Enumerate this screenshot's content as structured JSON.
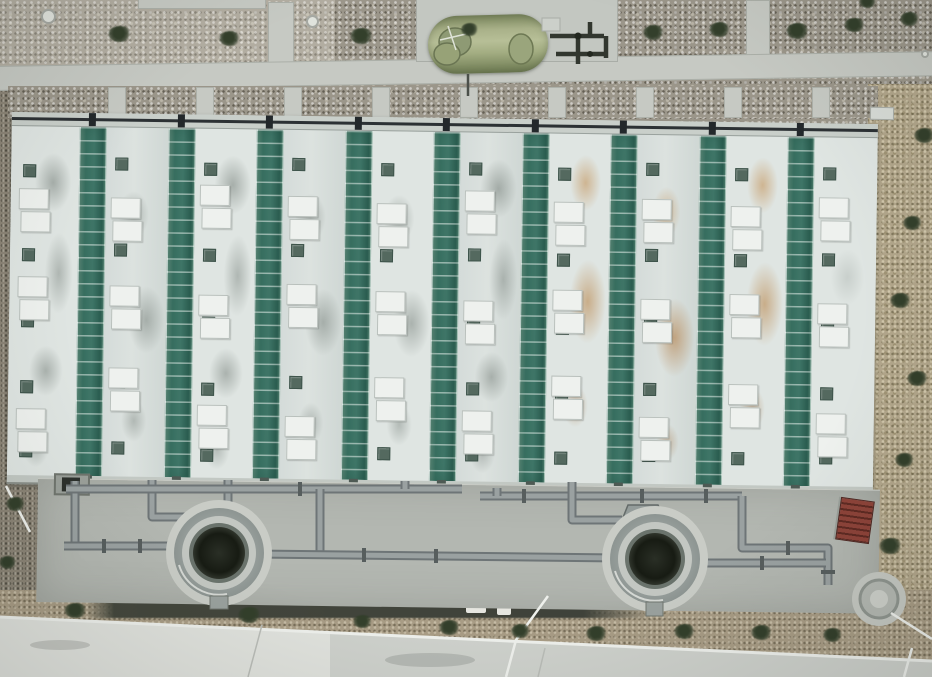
{
  "scene": {
    "width": 932,
    "height": 677,
    "description": "Aerial drone photograph of a wastewater treatment facility: long building with alternating white and green ribbed roof strips, concrete apron with two circular clarifier tanks and grey process piping, olive-green horizontal storage tank on a concrete pad at top, gravel grounds with shrubs, concrete paths, dirt strip and access road at bottom"
  },
  "palette": {
    "gravel": "#9b968a",
    "dry_grass": "#b2a68b",
    "dirt": "#a89c85",
    "concrete_path": "#c6c9c3",
    "apron": "#b3b7b1",
    "road": "#ced1cc",
    "roof_white": "#dfe5e2",
    "roof_green": "#3d7466",
    "roof_green_rib": "#7aa191",
    "eave": "#c9cfca",
    "pipe_grey": "#8b9293",
    "pipe_dark": "#23282b",
    "storage_tank_green": "#a9b189",
    "stairs_red": "#7e3a31",
    "shrub_green": "#333f2b",
    "trench_dark": "#44473d",
    "white_line": "#eef0ec"
  },
  "roof": {
    "x": 12,
    "y": 112,
    "w": 866,
    "h": 372,
    "rotate_deg": 0.8,
    "eave_h": 14,
    "bottom_h": 9,
    "green_w": 27,
    "greens": [
      68,
      157,
      245,
      334,
      422,
      511,
      599,
      688,
      776
    ],
    "whites": [
      {
        "x": 0,
        "w": 68,
        "tone": "a",
        "stain": "gray-a",
        "sqx": 12,
        "panx": 8,
        "squares": [
          38,
          122,
          188,
          254,
          318
        ],
        "panels": [
          62,
          150,
          282
        ]
      },
      {
        "x": 95,
        "w": 62,
        "tone": "b",
        "stain": "gray-b",
        "sqx": 9,
        "panx": 5,
        "squares": [
          30,
          116,
          182,
          248,
          314
        ],
        "panels": [
          70,
          158,
          240
        ]
      },
      {
        "x": 184,
        "w": 61,
        "tone": "a",
        "stain": "gray-a",
        "sqx": 9,
        "panx": 5,
        "squares": [
          34,
          120,
          188,
          254,
          320
        ],
        "panels": [
          56,
          166,
          276
        ]
      },
      {
        "x": 272,
        "w": 62,
        "tone": "b",
        "stain": "gray-b",
        "sqx": 9,
        "panx": 5,
        "squares": [
          28,
          114,
          180,
          246,
          312
        ],
        "panels": [
          66,
          154,
          286
        ]
      },
      {
        "x": 361,
        "w": 61,
        "tone": "a",
        "stain": "gray-b",
        "sqx": 9,
        "panx": 5,
        "squares": [
          32,
          118,
          186,
          252,
          316
        ],
        "panels": [
          72,
          160,
          246
        ]
      },
      {
        "x": 449,
        "w": 62,
        "tone": "b",
        "stain": "gray-a",
        "sqx": 9,
        "panx": 5,
        "squares": [
          30,
          116,
          184,
          250,
          316
        ],
        "panels": [
          58,
          168,
          278
        ]
      },
      {
        "x": 538,
        "w": 61,
        "tone": "a",
        "stain": "rust-a",
        "sqx": 9,
        "panx": 5,
        "squares": [
          34,
          120,
          188,
          254,
          318
        ],
        "panels": [
          68,
          156,
          242
        ]
      },
      {
        "x": 626,
        "w": 62,
        "tone": "b",
        "stain": "rust-b",
        "sqx": 9,
        "panx": 5,
        "squares": [
          28,
          114,
          182,
          248,
          314
        ],
        "panels": [
          64,
          164,
          282
        ]
      },
      {
        "x": 715,
        "w": 61,
        "tone": "a",
        "stain": "rust-a",
        "sqx": 9,
        "panx": 5,
        "squares": [
          32,
          118,
          186,
          252,
          316
        ],
        "panels": [
          70,
          158,
          248
        ]
      },
      {
        "x": 803,
        "w": 63,
        "tone": "a",
        "stain": "light",
        "sqx": 9,
        "panx": 5,
        "squares": [
          30,
          116,
          184,
          250,
          314
        ],
        "panels": [
          60,
          166,
          276
        ]
      }
    ]
  },
  "strips_v_x": [
    108,
    196,
    284,
    372,
    460,
    548,
    636,
    724,
    812
  ],
  "clarifiers": [
    {
      "cx": 219,
      "cy": 553,
      "funnel": "205,506 235,506 248,530 196,530",
      "tab": [
        210,
        596,
        18,
        13
      ]
    },
    {
      "cx": 655,
      "cy": 559,
      "funnel": "628,505 658,505 670,530 618,530",
      "tab": [
        646,
        602,
        17,
        14
      ]
    }
  ],
  "pipes": {
    "grey_runs": [
      "M75,481 L75,546",
      "M64,546 L172,546",
      "M152,480 L152,517 L192,517",
      "M228,480 L228,507",
      "M66,489 L462,489",
      "M320,489 L320,554",
      "M405,481 L405,489",
      "M252,554 L620,558",
      "M480,496 L742,496",
      "M497,488 L497,496",
      "M572,482 L572,520 L622,520",
      "M742,496 L742,548 L828,548 L828,585",
      "M700,563 L826,563"
    ],
    "flanges": [
      [
        104,
        546,
        "v"
      ],
      [
        140,
        546,
        "v"
      ],
      [
        300,
        489,
        "v"
      ],
      [
        364,
        555,
        "v"
      ],
      [
        436,
        556,
        "v"
      ],
      [
        524,
        496,
        "v"
      ],
      [
        642,
        496,
        "v"
      ],
      [
        706,
        496,
        "v"
      ],
      [
        788,
        548,
        "v"
      ],
      [
        762,
        563,
        "v"
      ],
      [
        828,
        572,
        "h"
      ]
    ]
  },
  "storage_tank_equipment": {
    "dark_lines": [
      "M550,36 L604,36",
      "M578,36 L578,64",
      "M556,54 L606,54",
      "M590,22 L590,36",
      "M606,36 L606,58"
    ],
    "drop_pipe": "M468,74 L468,96",
    "prop_marks": [
      "M440,40 L466,34",
      "M448,26 L456,50"
    ]
  },
  "white_lines": [
    "M6,486 L30,532",
    "M548,596 L516,640 L506,677",
    "M891,613 L932,639",
    "M912,648 L904,677"
  ],
  "road": {
    "curb": "M0,617 L932,661",
    "joints": [
      "M262,625 L248,677",
      "M545,648 L538,677"
    ],
    "streaks": [
      [
        430,
        660,
        90,
        14
      ],
      [
        60,
        645,
        60,
        10
      ]
    ]
  },
  "pad_circle": {
    "cx": 879,
    "cy": 599,
    "r": 27
  },
  "shrubs": {
    "top": [
      [
        120,
        34,
        24,
        16
      ],
      [
        230,
        38,
        22,
        15
      ],
      [
        362,
        36,
        24,
        16
      ],
      [
        470,
        29,
        18,
        13
      ],
      [
        654,
        32,
        22,
        15
      ],
      [
        720,
        29,
        22,
        15
      ],
      [
        798,
        31,
        24,
        16
      ],
      [
        855,
        25,
        22,
        14
      ],
      [
        910,
        19,
        20,
        14
      ],
      [
        868,
        2,
        18,
        12
      ]
    ],
    "right": [
      [
        925,
        135,
        22,
        15
      ],
      [
        913,
        223,
        20,
        14
      ],
      [
        901,
        300,
        22,
        15
      ],
      [
        918,
        378,
        22,
        15
      ],
      [
        905,
        460,
        20,
        14
      ],
      [
        891,
        546,
        24,
        16
      ]
    ],
    "bottom": [
      [
        76,
        610,
        24,
        15
      ],
      [
        250,
        615,
        24,
        16
      ],
      [
        363,
        621,
        20,
        13
      ],
      [
        450,
        627,
        22,
        15
      ],
      [
        521,
        631,
        20,
        14
      ],
      [
        597,
        633,
        22,
        15
      ],
      [
        685,
        631,
        22,
        15
      ],
      [
        762,
        632,
        22,
        15
      ],
      [
        833,
        635,
        20,
        14
      ]
    ],
    "left": [
      [
        16,
        504,
        20,
        14
      ],
      [
        8,
        562,
        18,
        13
      ]
    ]
  },
  "manholes": [
    [
      48,
      16,
      15
    ],
    [
      312,
      21,
      13
    ],
    [
      925,
      54,
      8
    ]
  ],
  "trench": {
    "x": 86,
    "y": 601,
    "w": 566,
    "h": 17,
    "patches": [
      [
        466,
        603,
        20,
        10
      ],
      [
        497,
        607,
        14,
        8
      ]
    ]
  }
}
